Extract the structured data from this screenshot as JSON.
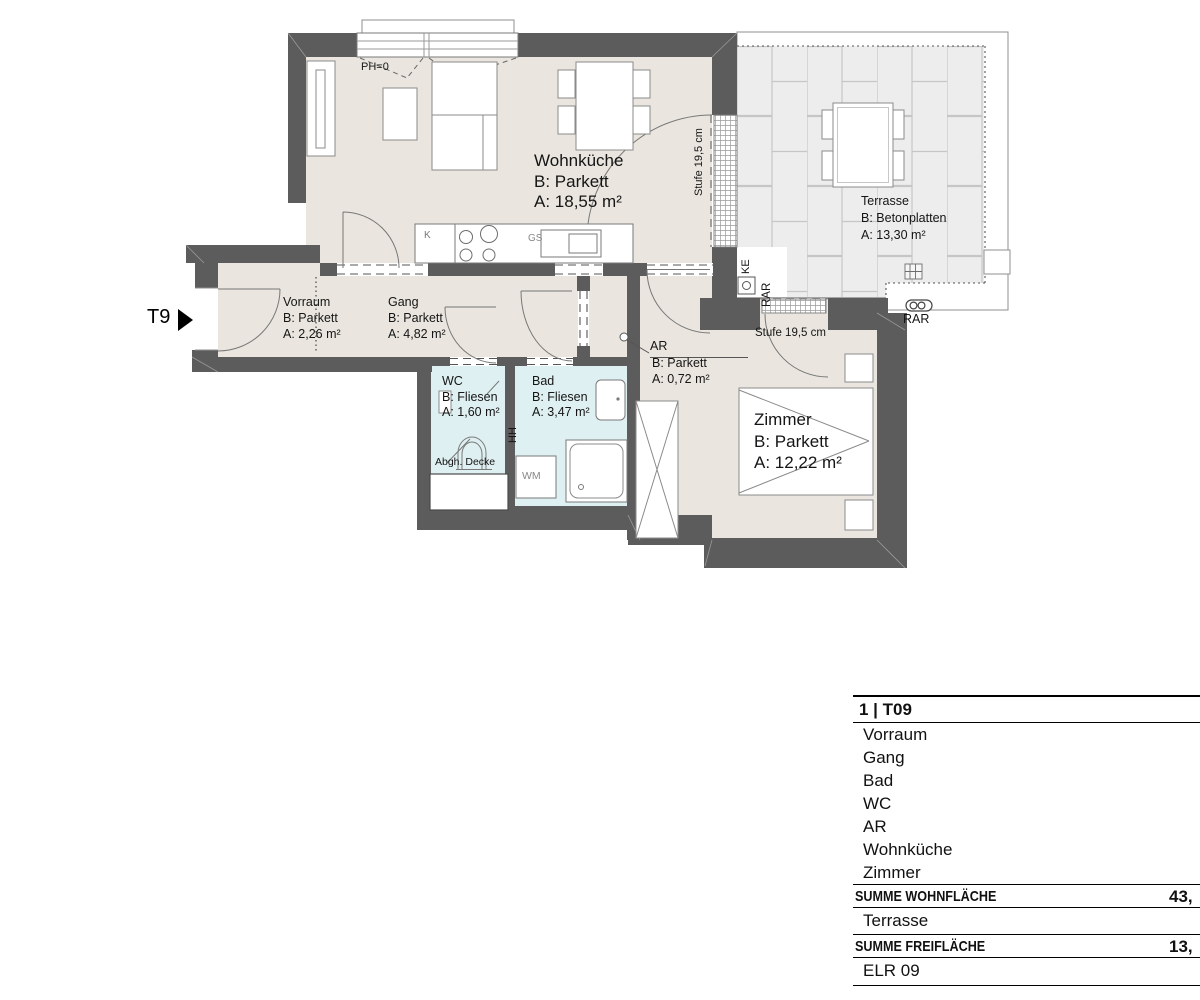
{
  "plan": {
    "entrance_label": "T9",
    "rooms": {
      "wohnkueche": {
        "name": "Wohnküche",
        "floor": "B: Parkett",
        "area": "A: 18,55 m²"
      },
      "terrasse": {
        "name": "Terrasse",
        "floor": "B: Betonplatten",
        "area": "A: 13,30 m²"
      },
      "vorraum": {
        "name": "Vorraum",
        "floor": "B: Parkett",
        "area": "A: 2,26 m²"
      },
      "gang": {
        "name": "Gang",
        "floor": "B: Parkett",
        "area": "A: 4,82 m²"
      },
      "wc": {
        "name": "WC",
        "floor": "B: Fliesen",
        "area": "A: 1,60 m²"
      },
      "bad": {
        "name": "Bad",
        "floor": "B: Fliesen",
        "area": "A: 3,47 m²"
      },
      "ar": {
        "name": "AR",
        "floor": "B: Parkett",
        "area": "A: 0,72 m²"
      },
      "zimmer": {
        "name": "Zimmer",
        "floor": "B: Parkett",
        "area": "A: 12,22 m²"
      }
    },
    "annotations": {
      "ph": "PH=0",
      "stufe_terrace": "Stufe 19,5 cm",
      "stufe_zimmer": "Stufe 19,5 cm",
      "ke": "KE",
      "rar_vertical": "RAR",
      "rar_horizontal": "RAR",
      "abgh_decke": "Abgh. Decke",
      "hh": "HH",
      "wm": "WM",
      "kitchen_k": "K",
      "kitchen_gs": "GS"
    },
    "colors": {
      "wall": "#5c5c5c",
      "floor": "#eae6df",
      "wet_room": "#dff0f2",
      "terrace_tile": "#ededed"
    }
  },
  "table": {
    "header": "1 | T09",
    "rooms": [
      "Vorraum",
      "Gang",
      "Bad",
      "WC",
      "AR",
      "Wohnküche",
      "Zimmer"
    ],
    "sum_living": {
      "label": "SUMME WOHNFLÄCHE",
      "value": "43,"
    },
    "outdoor_room": "Terrasse",
    "sum_outdoor": {
      "label": "SUMME FREIFLÄCHE",
      "value": "13,"
    },
    "footer": "ELR 09"
  }
}
